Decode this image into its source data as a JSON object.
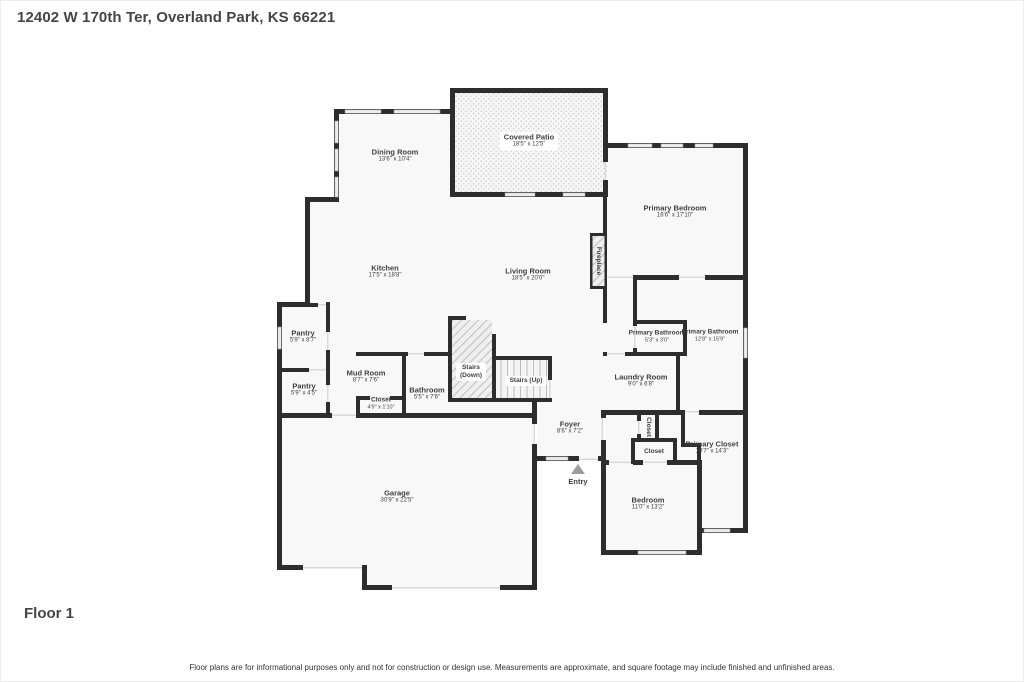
{
  "page": {
    "title": "12402 W 170th Ter, Overland Park, KS 66221",
    "floor_label": "Floor 1",
    "disclaimer": "Floor plans are for informational purposes only and not for construction or design use. Measurements are approximate, and square footage may include finished and unfinished areas."
  },
  "rooms": {
    "dining_room": {
      "name": "Dining Room",
      "dims": "13'6\" x 10'4\""
    },
    "covered_patio": {
      "name": "Covered Patio",
      "dims": "18'5\" x 12'5\""
    },
    "primary_bedroom": {
      "name": "Primary Bedroom",
      "dims": "16'6\" x 17'10\""
    },
    "kitchen": {
      "name": "Kitchen",
      "dims": "17'5\" x 18'8\""
    },
    "living_room": {
      "name": "Living Room",
      "dims": "18'5\" x 20'0\""
    },
    "fireplace": {
      "name": "Fireplace"
    },
    "pantry_upper": {
      "name": "Pantry",
      "dims": "5'9\" x 8'7\""
    },
    "pantry_lower": {
      "name": "Pantry",
      "dims": "5'9\" x 4'5\""
    },
    "mud_room": {
      "name": "Mud Room",
      "dims": "8'7\" x 7'6\""
    },
    "mud_closet": {
      "name": "Closet",
      "dims": "4'9\" x 1'10\""
    },
    "bathroom": {
      "name": "Bathroom",
      "dims": "5'5\" x 7'6\""
    },
    "stairs_down": {
      "name": "Stairs",
      "sub": "(Down)"
    },
    "stairs_up": {
      "name": "Stairs (Up)"
    },
    "primary_bathroom_wc": {
      "name": "Primary Bathroom",
      "dims": "5'3\" x 3'0\""
    },
    "primary_bathroom": {
      "name": "Primary Bathroom",
      "dims": "12'8\" x 15'9\""
    },
    "laundry_room": {
      "name": "Laundry Room",
      "dims": "9'0\" x 6'8\""
    },
    "foyer": {
      "name": "Foyer",
      "dims": "8'6\" x 7'2\""
    },
    "closet_hall": {
      "name": "Closet"
    },
    "closet_bedroom": {
      "name": "Closet"
    },
    "primary_closet": {
      "name": "Primary Closet",
      "dims": "10'7\" x 14'3\""
    },
    "garage": {
      "name": "Garage",
      "dims": "30'9\" x 22'5\""
    },
    "bedroom": {
      "name": "Bedroom",
      "dims": "11'0\" x 13'2\""
    },
    "entry": {
      "name": "Entry"
    }
  },
  "colors": {
    "wall": "#2d2d2d",
    "floor": "#f8f8f8",
    "window": "#ececec",
    "opening": "#d9d9d9",
    "label_text": "#3f3f3f"
  }
}
